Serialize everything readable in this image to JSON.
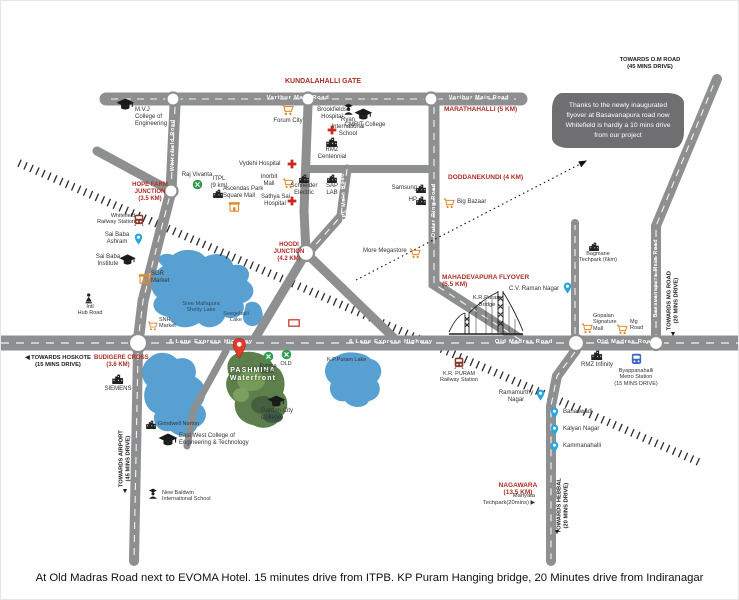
{
  "caption": "At Old Madras Road next to EVOMA Hotel. 15 minutes drive from ITPB. KP Puram Hanging bridge, 20 Minutes drive from Indiranagar",
  "callout": {
    "text": "Thanks to the newly inaugurated flyover at Basavanapura road now Whitefield is hardly a 10 mins drive from our project"
  },
  "project": {
    "name_line1": "PASHMINA",
    "name_line2": "Waterfront"
  },
  "colors": {
    "road": "#8e8f91",
    "lake": "#58a0d2",
    "area_label_red": "#ad2e25",
    "callout_bg": "#6f6f72",
    "pin_blue": "#2aa7de",
    "pin_red": "#e23b2c",
    "mall_orange": "#e08a2e",
    "hotel_green": "#2f9e4e",
    "site_green": "#5d7f4c"
  },
  "labels": [
    {
      "n": "kundalahalli-gate",
      "cls": "red",
      "lines": [
        "KUNDALAHALLI GATE"
      ],
      "x": 272,
      "y": 77,
      "w": 100,
      "ta": "c",
      "fs": 7
    },
    {
      "n": "marathahalli",
      "cls": "red",
      "lines": [
        "MARATHAHALLI (5 KM)"
      ],
      "x": 443,
      "y": 105,
      "w": 92,
      "ta": "l",
      "fs": 6.5
    },
    {
      "n": "hope-farm-junction",
      "cls": "red",
      "lines": [
        "HOPE FARM",
        "JUNCTION",
        "(3.5 KM)"
      ],
      "x": 130,
      "y": 181,
      "w": 38,
      "ta": "c",
      "fs": 6
    },
    {
      "n": "doddanekundi",
      "cls": "red",
      "lines": [
        "DODDANEKUNDI (4 KM)"
      ],
      "x": 447,
      "y": 173,
      "w": 96,
      "ta": "l",
      "fs": 6.5
    },
    {
      "n": "hoodi-junction",
      "cls": "red",
      "lines": [
        "HOODI",
        "JUNCTION",
        "(4.2 KM)"
      ],
      "x": 272,
      "y": 241,
      "w": 32,
      "ta": "c",
      "fs": 6
    },
    {
      "n": "mahadevapura-flyover",
      "cls": "red",
      "lines": [
        "MAHADEVAPURA FLYOVER",
        "(5.5 KM)"
      ],
      "x": 441,
      "y": 273,
      "w": 96,
      "ta": "l",
      "fs": 6.5
    },
    {
      "n": "budigere-cross",
      "cls": "red",
      "lines": [
        "BUDIGERE CROSS",
        "(3.6 KM)"
      ],
      "x": 93,
      "y": 354,
      "w": 48,
      "ta": "c",
      "fs": 6
    },
    {
      "n": "nagawara",
      "cls": "red",
      "lines": [
        "NAGAWARA",
        "(13.5 KM)"
      ],
      "x": 496,
      "y": 481,
      "w": 42,
      "ta": "c",
      "fs": 6.5
    },
    {
      "n": "towards-hoskote",
      "cls": "dir",
      "lines": [
        "◀ TOWARDS HOSKOTE",
        "(15 MINS DRIVE)"
      ],
      "x": 24,
      "y": 354,
      "w": 66,
      "ta": "c",
      "fs": 5.8
    },
    {
      "n": "towards-airport",
      "cls": "dir",
      "lines": [
        "TOWARDS AIRPORT",
        "(45 MINS DRIVE)"
      ],
      "x": 84,
      "y": 451,
      "w": 80,
      "ta": "c",
      "rot": -90,
      "fs": 5.8
    },
    {
      "n": "towards-airport-arrow",
      "cls": "dir",
      "lines": [
        "▼"
      ],
      "x": 116,
      "y": 487,
      "w": 16,
      "ta": "c",
      "fs": 7
    },
    {
      "n": "towards-mg-road",
      "cls": "dir",
      "lines": [
        "TOWARDS MG ROAD",
        "(20 MINS DRIVE)"
      ],
      "x": 632,
      "y": 293,
      "w": 80,
      "ta": "c",
      "rot": -90,
      "fs": 5.8
    },
    {
      "n": "towards-mg-road-arrow",
      "cls": "dir",
      "lines": [
        "▼"
      ],
      "x": 664,
      "y": 330,
      "w": 16,
      "ta": "c",
      "fs": 7
    },
    {
      "n": "towards-hebbal",
      "cls": "dir",
      "lines": [
        "TOWARDS HEBBAL",
        "(20 MINS DRIVE)"
      ],
      "x": 522,
      "y": 498,
      "w": 80,
      "ta": "c",
      "rot": -90,
      "fs": 5.8
    },
    {
      "n": "towards-hebbal-arrow",
      "cls": "dir",
      "lines": [
        "▼"
      ],
      "x": 548,
      "y": 528,
      "w": 16,
      "ta": "c",
      "fs": 7
    },
    {
      "n": "towards-om-road",
      "cls": "dir",
      "lines": [
        "TOWARDS O.M ROAD",
        "(45 MINS DRIVE)"
      ],
      "x": 604,
      "y": 56,
      "w": 90,
      "ta": "c",
      "fs": 5.8
    },
    {
      "n": "varthur-main-road-label-1",
      "cls": "road",
      "lines": [
        "Varthur Main Road"
      ],
      "x": 252,
      "y": 94,
      "w": 90,
      "ta": "c",
      "fs": 5.8
    },
    {
      "n": "varthur-main-road-label-2",
      "cls": "road",
      "lines": [
        "Varthur Main Road"
      ],
      "x": 436,
      "y": 94,
      "w": 84,
      "ta": "c",
      "fs": 5.5
    },
    {
      "n": "whitefield-road-label",
      "cls": "road",
      "lines": [
        "Whitefield Road"
      ],
      "x": 140,
      "y": 141,
      "w": 64,
      "ta": "c",
      "rot": -90,
      "fs": 5.5
    },
    {
      "n": "itpl-main-road-label",
      "cls": "road",
      "lines": [
        "ITPL Main Road"
      ],
      "x": 313,
      "y": 194,
      "w": 60,
      "ta": "c",
      "rot": -93,
      "fs": 5.5
    },
    {
      "n": "outer-ring-road-label",
      "cls": "road",
      "lines": [
        "Outer Ring Road"
      ],
      "x": 400,
      "y": 206,
      "w": 66,
      "ta": "c",
      "rot": -90,
      "fs": 5.5
    },
    {
      "n": "highway-label-1",
      "cls": "road",
      "lines": [
        "6 Lane Express Highway"
      ],
      "x": 150,
      "y": 338,
      "w": 120,
      "ta": "c",
      "fs": 5.8
    },
    {
      "n": "highway-label-2",
      "cls": "road",
      "lines": [
        "6 Lane Express Highway"
      ],
      "x": 330,
      "y": 338,
      "w": 120,
      "ta": "c",
      "fs": 5.8
    },
    {
      "n": "old-madras-road-label-1",
      "cls": "road",
      "lines": [
        "Old Madras Road"
      ],
      "x": 478,
      "y": 338,
      "w": 90,
      "ta": "c",
      "fs": 5.8
    },
    {
      "n": "old-madras-road-label-2",
      "cls": "road",
      "lines": [
        "Old Madras Road"
      ],
      "x": 580,
      "y": 338,
      "w": 90,
      "ta": "c",
      "fs": 5.8
    },
    {
      "n": "basavanapura-road-label",
      "cls": "road",
      "lines": [
        "Basavanapura Main Road"
      ],
      "x": 610,
      "y": 274,
      "w": 92,
      "ta": "c",
      "rot": -90,
      "fs": 5.2
    },
    {
      "n": "kr-puram-bridge-label",
      "cls": "plain",
      "lines": [
        "K.R.Puram",
        "Bridge"
      ],
      "x": 468,
      "y": 294,
      "w": 36,
      "ta": "c",
      "fs": 5.8
    },
    {
      "n": "manyata-techpark",
      "cls": "plain",
      "lines": [
        "Manyata",
        "Techpark(20mins) ▶"
      ],
      "x": 458,
      "y": 492,
      "w": 76,
      "ta": "r",
      "fs": 5.8
    },
    {
      "n": "lake-label-big",
      "cls": "lake",
      "lines": [
        "Sree Mallapura",
        "Shetty Lake"
      ],
      "x": 176,
      "y": 300,
      "w": 48,
      "ta": "c",
      "fs": 5.5
    },
    {
      "n": "seegehalli-lake-label",
      "cls": "lake",
      "lines": [
        "Seegehalli",
        "Lake"
      ],
      "x": 220,
      "y": 310,
      "w": 30,
      "ta": "c",
      "fs": 5.5
    },
    {
      "n": "kp-puram-lake-label",
      "cls": "plain",
      "lines": [
        "K.P.Puram Lake"
      ],
      "x": 326,
      "y": 356,
      "w": 52,
      "ta": "l",
      "fs": 5.5
    },
    {
      "n": "project-name",
      "cls": "project",
      "lines": [
        "PASHMINA",
        "Waterfront"
      ],
      "x": 224,
      "y": 366,
      "w": 56,
      "ta": "c",
      "fs": 7
    }
  ],
  "markers": [
    {
      "n": "mvj-college",
      "i": "cap",
      "ix": 124,
      "iy": 103,
      "s": 13,
      "lines": [
        "M.V.J",
        "College of",
        "Engineering"
      ],
      "tx": 134,
      "ty": 106,
      "tw": 44,
      "ta": "l"
    },
    {
      "n": "ryan-school",
      "i": "school",
      "ix": 347,
      "iy": 108,
      "s": 13,
      "lines": [
        "Ryan",
        "International",
        "School"
      ],
      "tx": 327,
      "ty": 116,
      "tw": 40,
      "ta": "c"
    },
    {
      "n": "forum-city",
      "i": "cart",
      "ix": 287,
      "iy": 109,
      "s": 12,
      "lines": [
        "Forum City"
      ],
      "tx": 267,
      "ty": 117,
      "tw": 40,
      "ta": "c"
    },
    {
      "n": "brookfields-hospital",
      "i": "cross",
      "ix": 331,
      "iy": 129,
      "s": 10,
      "lines": [
        "Brookfields",
        "Hospital"
      ],
      "tx": 312,
      "ty": 106,
      "tw": 38,
      "ta": "c"
    },
    {
      "n": "cmrit-college",
      "i": "cap",
      "ix": 362,
      "iy": 113,
      "s": 13,
      "lines": [
        "CMRIT College"
      ],
      "tx": 342,
      "ty": 121,
      "tw": 44,
      "ta": "c"
    },
    {
      "n": "vydehi-hospital",
      "i": "cross",
      "ix": 291,
      "iy": 163,
      "s": 10,
      "lines": [
        "Vydehi Hospital"
      ],
      "tx": 238,
      "ty": 160,
      "tw": 48,
      "ta": "l"
    },
    {
      "n": "inorbit-mall",
      "i": "cart",
      "ix": 287,
      "iy": 182,
      "s": 11,
      "lines": [
        "Inorbit",
        "Mall"
      ],
      "tx": 255,
      "ty": 173,
      "tw": 26,
      "ta": "c"
    },
    {
      "n": "raj-vivanta",
      "i": "dot",
      "ix": 196,
      "iy": 183,
      "s": 11,
      "lines": [
        "Raj Vivanta"
      ],
      "tx": 178,
      "ty": 171,
      "tw": 36,
      "ta": "c"
    },
    {
      "n": "itpl",
      "i": "bld",
      "ix": 217,
      "iy": 192,
      "s": 9,
      "lines": [
        "ITPL",
        "(9 km)"
      ],
      "tx": 205,
      "ty": 175,
      "tw": 26,
      "ta": "c"
    },
    {
      "n": "ascendas-park-square-mall",
      "i": "shop",
      "ix": 233,
      "iy": 205,
      "s": 11,
      "lines": [
        "Ascendas Park",
        "Square Mall"
      ],
      "tx": 222,
      "ty": 185,
      "tw": 44,
      "ta": "l"
    },
    {
      "n": "sathya-sai-hospital",
      "i": "cross",
      "ix": 291,
      "iy": 200,
      "s": 10,
      "lines": [
        "Sathya Sai",
        "Hospital"
      ],
      "tx": 260,
      "ty": 193,
      "tw": 28,
      "ta": "c"
    },
    {
      "n": "rmz-centennial",
      "i": "bld",
      "ix": 331,
      "iy": 141,
      "s": 10,
      "lines": [
        "RMZ",
        "Centennial"
      ],
      "tx": 313,
      "ty": 146,
      "tw": 36,
      "ta": "c"
    },
    {
      "n": "schneider-electric",
      "i": "bld",
      "ix": 303,
      "iy": 177,
      "s": 9,
      "lines": [
        "Schneider",
        "Electric"
      ],
      "tx": 289,
      "ty": 182,
      "tw": 28,
      "ta": "c"
    },
    {
      "n": "sap-lab",
      "i": "bld",
      "ix": 331,
      "iy": 177,
      "s": 9,
      "lines": [
        "SAP",
        "LAB"
      ],
      "tx": 322,
      "ty": 182,
      "tw": 18,
      "ta": "c"
    },
    {
      "n": "samsung",
      "i": "bld",
      "ix": 420,
      "iy": 187,
      "s": 9,
      "lines": [
        "Samsung"
      ],
      "tx": 388,
      "ty": 184,
      "tw": 28,
      "ta": "r"
    },
    {
      "n": "hp",
      "i": "bld",
      "ix": 420,
      "iy": 199,
      "s": 9,
      "lines": [
        "HP"
      ],
      "tx": 398,
      "ty": 196,
      "tw": 18,
      "ta": "r"
    },
    {
      "n": "more-megastore",
      "i": "cart",
      "ix": 414,
      "iy": 252,
      "s": 11,
      "lines": [
        "More Megastore"
      ],
      "tx": 362,
      "ty": 247,
      "tw": 48,
      "ta": "l"
    },
    {
      "n": "big-bazaar",
      "i": "cart",
      "ix": 448,
      "iy": 202,
      "s": 11,
      "lines": [
        "Big Bazaar"
      ],
      "tx": 456,
      "ty": 198,
      "tw": 36,
      "ta": "l"
    },
    {
      "n": "bagmane-techpark",
      "i": "bld",
      "ix": 593,
      "iy": 245,
      "s": 9,
      "lines": [
        "Bagmane",
        "Techpark (6km)"
      ],
      "tx": 574,
      "ty": 250,
      "tw": 46,
      "ta": "c",
      "fs": 5.5
    },
    {
      "n": "cv-raman-nagar",
      "i": "pin",
      "ix": 566,
      "iy": 287,
      "s": 12,
      "lines": [
        "C.V. Raman Nagar"
      ],
      "tx": 508,
      "ty": 285,
      "tw": 52,
      "ta": "l"
    },
    {
      "n": "gopalan-signature-mall",
      "i": "cart",
      "ix": 586,
      "iy": 327,
      "s": 11,
      "lines": [
        "Gopalan",
        "Signature",
        "Mall"
      ],
      "tx": 592,
      "ty": 312,
      "tw": 30,
      "ta": "l",
      "fs": 5.5
    },
    {
      "n": "mg-road-mall",
      "i": "cart",
      "ix": 621,
      "iy": 328,
      "s": 11,
      "lines": [
        "Mg",
        "Road"
      ],
      "tx": 629,
      "ty": 318,
      "tw": 20,
      "ta": "l",
      "fs": 5.5
    },
    {
      "n": "whitefield-railway-station",
      "i": "train",
      "ix": 138,
      "iy": 219,
      "s": 12,
      "lines": [
        "Whitefield",
        "Railway Station"
      ],
      "tx": 92,
      "ty": 212,
      "tw": 42,
      "ta": "r",
      "fs": 5.5
    },
    {
      "n": "sai-baba-ashram",
      "i": "pin",
      "ix": 137,
      "iy": 238,
      "s": 12,
      "lines": [
        "Sai Baba",
        "Ashram"
      ],
      "tx": 102,
      "ty": 231,
      "tw": 28,
      "ta": "c"
    },
    {
      "n": "sai-baba-institute",
      "i": "cap",
      "ix": 127,
      "iy": 259,
      "s": 12,
      "lines": [
        "Sai Baba",
        "Institute"
      ],
      "tx": 92,
      "ty": 253,
      "tw": 30,
      "ta": "c"
    },
    {
      "n": "sgr-market",
      "i": "shop",
      "ix": 143,
      "iy": 277,
      "s": 11,
      "lines": [
        "SGR",
        "Market"
      ],
      "tx": 150,
      "ty": 270,
      "tw": 24,
      "ta": "l"
    },
    {
      "n": "hub-road",
      "i": "person",
      "ix": 88,
      "iy": 297,
      "s": 11,
      "lines": [
        "Intl",
        "Hub Road"
      ],
      "tx": 74,
      "ty": 303,
      "tw": 30,
      "ta": "c",
      "fs": 5.5
    },
    {
      "n": "snr-market",
      "i": "cart",
      "ix": 152,
      "iy": 325,
      "s": 10,
      "lines": [
        "SNR",
        "Market"
      ],
      "tx": 158,
      "ty": 316,
      "tw": 24,
      "ta": "l",
      "fs": 5.5
    },
    {
      "n": "evoma-hotel",
      "i": "dot",
      "ix": 267,
      "iy": 355,
      "s": 11,
      "lines": [
        "Evoma",
        "Hotel"
      ],
      "tx": 256,
      "ty": 362,
      "tw": 22,
      "ta": "c",
      "fs": 5.5
    },
    {
      "n": "old-marker",
      "i": "dot",
      "ix": 285,
      "iy": 353,
      "s": 11,
      "lines": [
        "OLD"
      ],
      "tx": 277,
      "ty": 360,
      "tw": 16,
      "ta": "c",
      "fs": 5.5
    },
    {
      "n": "garden-city-college",
      "i": "cap",
      "ix": 275,
      "iy": 400,
      "s": 13,
      "lines": [
        "Garden City",
        "College"
      ],
      "tx": 260,
      "ty": 407,
      "tw": 38,
      "ta": "l"
    },
    {
      "n": "east-west-college",
      "i": "cap",
      "ix": 167,
      "iy": 439,
      "s": 14,
      "lines": [
        "East West College of",
        "Engineering & Technology"
      ],
      "tx": 178,
      "ty": 432,
      "tw": 72,
      "ta": "l"
    },
    {
      "n": "grindwell-norton",
      "i": "bld",
      "ix": 150,
      "iy": 423,
      "s": 9,
      "lines": [
        "Grindwell Norton"
      ],
      "tx": 157,
      "ty": 420,
      "tw": 52,
      "ta": "l",
      "fs": 5.5
    },
    {
      "n": "new-baldwin-school",
      "i": "school",
      "ix": 152,
      "iy": 493,
      "s": 12,
      "lines": [
        "New Baldwin",
        "International School"
      ],
      "tx": 161,
      "ty": 489,
      "tw": 62,
      "ta": "l",
      "fs": 5.5
    },
    {
      "n": "siemens",
      "i": "bld",
      "ix": 117,
      "iy": 378,
      "s": 10,
      "lines": [
        "SIEMENS"
      ],
      "tx": 101,
      "ty": 385,
      "tw": 32,
      "ta": "c"
    },
    {
      "n": "kr-puram-railway-station",
      "i": "train",
      "ix": 458,
      "iy": 362,
      "s": 12,
      "lines": [
        "K.R. PURAM",
        "Railway Station"
      ],
      "tx": 436,
      "ty": 370,
      "tw": 44,
      "ta": "c",
      "fs": 5.5
    },
    {
      "n": "ramamurthy-nagar",
      "i": "pin",
      "ix": 539,
      "iy": 394,
      "s": 12,
      "lines": [
        "Ramamurthy",
        "Nagar"
      ],
      "tx": 496,
      "ty": 389,
      "tw": 38,
      "ta": "c"
    },
    {
      "n": "banaswadi",
      "i": "pin",
      "ix": 553,
      "iy": 412,
      "s": 12,
      "lines": [
        "Banaswadi"
      ],
      "tx": 562,
      "ty": 408,
      "tw": 36,
      "ta": "l"
    },
    {
      "n": "kalyan-nagar",
      "i": "pin",
      "ix": 553,
      "iy": 429,
      "s": 12,
      "lines": [
        "Kalyan Nagar"
      ],
      "tx": 562,
      "ty": 425,
      "tw": 40,
      "ta": "l"
    },
    {
      "n": "kammanahalli",
      "i": "pin",
      "ix": 553,
      "iy": 446,
      "s": 12,
      "lines": [
        "Kammanahalli"
      ],
      "tx": 562,
      "ty": 442,
      "tw": 42,
      "ta": "l"
    },
    {
      "n": "rmz-infinity",
      "i": "bld",
      "ix": 596,
      "iy": 354,
      "s": 10,
      "lines": [
        "RMZ Infinity"
      ],
      "tx": 576,
      "ty": 361,
      "tw": 40,
      "ta": "c"
    },
    {
      "n": "byappanahalli-metro",
      "i": "metro",
      "ix": 635,
      "iy": 358,
      "s": 13,
      "lines": [
        "Byappanahalli",
        "Metro Station",
        "(15 MINS DRIVE)"
      ],
      "tx": 610,
      "ty": 367,
      "tw": 50,
      "ta": "c",
      "fs": 5.5
    },
    {
      "n": "substation-box",
      "i": "redbox",
      "ix": 293,
      "iy": 322,
      "s": 8,
      "lines": [],
      "tx": 0,
      "ty": 0,
      "tw": 0,
      "ta": "l"
    },
    {
      "n": "project-pin",
      "i": "redpin",
      "ix": 238,
      "iy": 347,
      "s": 22,
      "lines": [],
      "tx": 0,
      "ty": 0,
      "tw": 0,
      "ta": "l"
    }
  ]
}
